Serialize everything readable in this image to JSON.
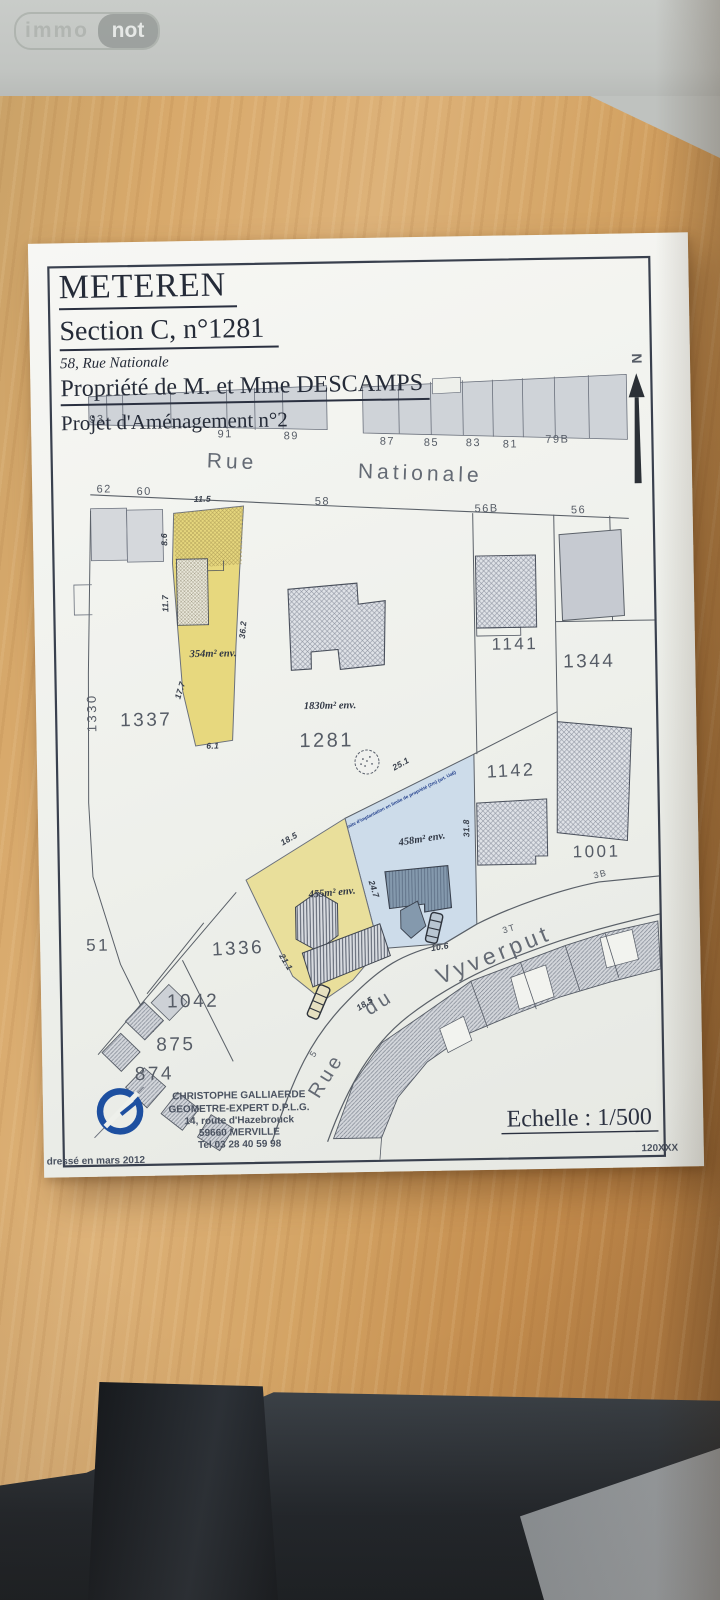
{
  "watermark": {
    "immo": "immo",
    "not": "not"
  },
  "title_block": {
    "commune": "METEREN",
    "section": "Section C, n°1281",
    "address": "58, Rue Nationale",
    "owner": "Propriété de M. et Mme DESCAMPS",
    "project": "Projet d'Aménagement n°2"
  },
  "north_label": "N",
  "streets": {
    "nationale_word1": "Rue",
    "nationale_word2": "Nationale",
    "vyverput_word1": "Rue",
    "vyverput_word2": "du",
    "vyverput_word3": "Vyverput"
  },
  "north_houses": [
    "93",
    "91",
    "89",
    "87",
    "85",
    "83",
    "81",
    "79B"
  ],
  "south_houses": [
    "62",
    "60",
    "58",
    "56B",
    "56"
  ],
  "vyverput_houses": [
    "5",
    "4B",
    "3T",
    "4",
    "2",
    "3B"
  ],
  "parcels": {
    "p1337": "1337",
    "p1330": "1330",
    "p1281": "1281",
    "p1141": "1141",
    "p1344": "1344",
    "p1142": "1142",
    "p1001": "1001",
    "p1336": "1336",
    "p1042": "1042",
    "p875": "875",
    "p874": "874",
    "p51": "51"
  },
  "areas": {
    "a354": "354m² env.",
    "a1830": "1830m² env.",
    "a458": "458m² env.",
    "a455": "455m² env."
  },
  "measurements": {
    "m11_5": "11.5",
    "m8_6": "8.6",
    "m11_7": "11.7",
    "m36_2": "36.2",
    "m17_7": "17.7",
    "m6_1": "6.1",
    "m25_1": "25.1",
    "m31_8": "31.8",
    "m24_7": "24.7",
    "m18_5_a": "18.5",
    "m18_5_b": "18.5",
    "m21_1": "21.1",
    "m10_6": "10.6"
  },
  "annotations": {
    "limite": "Limite d'implantation en limite de propriété (2m) (art. Ua6)"
  },
  "surveyor": {
    "name": "CHRISTOPHE GALLIAERDE",
    "title": "GEOMETRE-EXPERT D.P.L.G.",
    "address1": "14, route d'Hazebrouck",
    "address2": "59660 MERVILLE",
    "phone": "Tel 03 28 40 59 98"
  },
  "footer": {
    "scale": "Echelle : 1/500",
    "ref": "120XXX",
    "date_note": "Plan dressé en mars 2012"
  },
  "colors": {
    "parcel_yellow": "#e7d87e",
    "parcel_yellow_lower": "#e9df9b",
    "parcel_blue": "#cddcea",
    "building_gray": "#c6cad1",
    "logo_blue": "#1d4fa0",
    "ink": "#3a4150"
  }
}
